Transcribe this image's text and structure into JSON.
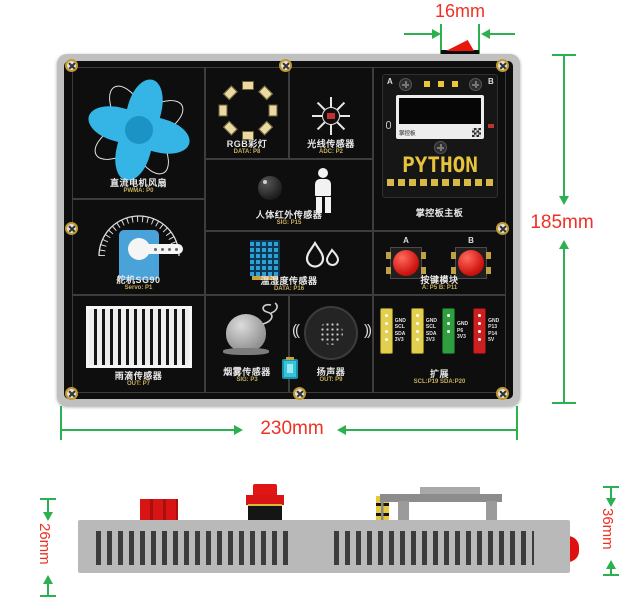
{
  "dimensions": {
    "connector_width": "16mm",
    "panel_height": "185mm",
    "panel_width": "230mm",
    "side_thickness": "26mm",
    "side_total": "36mm"
  },
  "panel": {
    "sections": {
      "fan": {
        "label": "直流电机风扇",
        "pin": "PWMA: P0"
      },
      "rgb": {
        "label": "RGB彩灯",
        "pin": "DATA: P8"
      },
      "light": {
        "label": "光线传感器",
        "pin": "ADC: P2"
      },
      "mainboard": {
        "label": "掌控板主板",
        "btn_a": "A",
        "btn_b": "B",
        "logo": "掌控板",
        "pads": "PYTHON"
      },
      "pir": {
        "label": "人体红外传感器",
        "pin": "SIG: P15"
      },
      "temp": {
        "label": "温湿度传感器",
        "pin": "DATA: P16"
      },
      "buttons": {
        "label": "按键模块",
        "pin": "A: P5   B: P11",
        "btn_a": "A",
        "btn_b": "B"
      },
      "servo": {
        "label": "舵机SG90",
        "pin": "Servo: P1"
      },
      "rain": {
        "label": "雨滴传感器",
        "pin": "OUT: P7"
      },
      "smoke": {
        "label": "烟雾传感器",
        "pin": "SIG: P3"
      },
      "speaker": {
        "label": "扬声器",
        "pin": "OUT: P9"
      },
      "expansion": {
        "label": "扩展",
        "pin": "SCL:P19 SDA:P20",
        "connectors": [
          {
            "name": "i2c-connector-yellow-1",
            "pins": [
              "GND",
              "SCL",
              "SDA",
              "3V3"
            ]
          },
          {
            "name": "i2c-connector-yellow-2",
            "pins": [
              "GND",
              "SCL",
              "SDA",
              "3V3"
            ]
          },
          {
            "name": "io-connector-green",
            "pins": [
              "GND",
              "P6",
              "3V3"
            ]
          },
          {
            "name": "power-connector-red",
            "pins": [
              "GND",
              "P13",
              "P14",
              "5V"
            ]
          }
        ]
      }
    }
  },
  "icons": {
    "speaker_wave_left": "((",
    "speaker_wave_right": "))"
  },
  "colors": {
    "dimension_line": "#2db04f",
    "dimension_text": "#ee3124",
    "panel": "#0e0e0e",
    "frame": "#c0c0c0",
    "fan_blue": "#35b5e5",
    "servo_blue": "#4aa3d8",
    "sensor_blue": "#2f9fd8",
    "button_red": "#d81414"
  }
}
